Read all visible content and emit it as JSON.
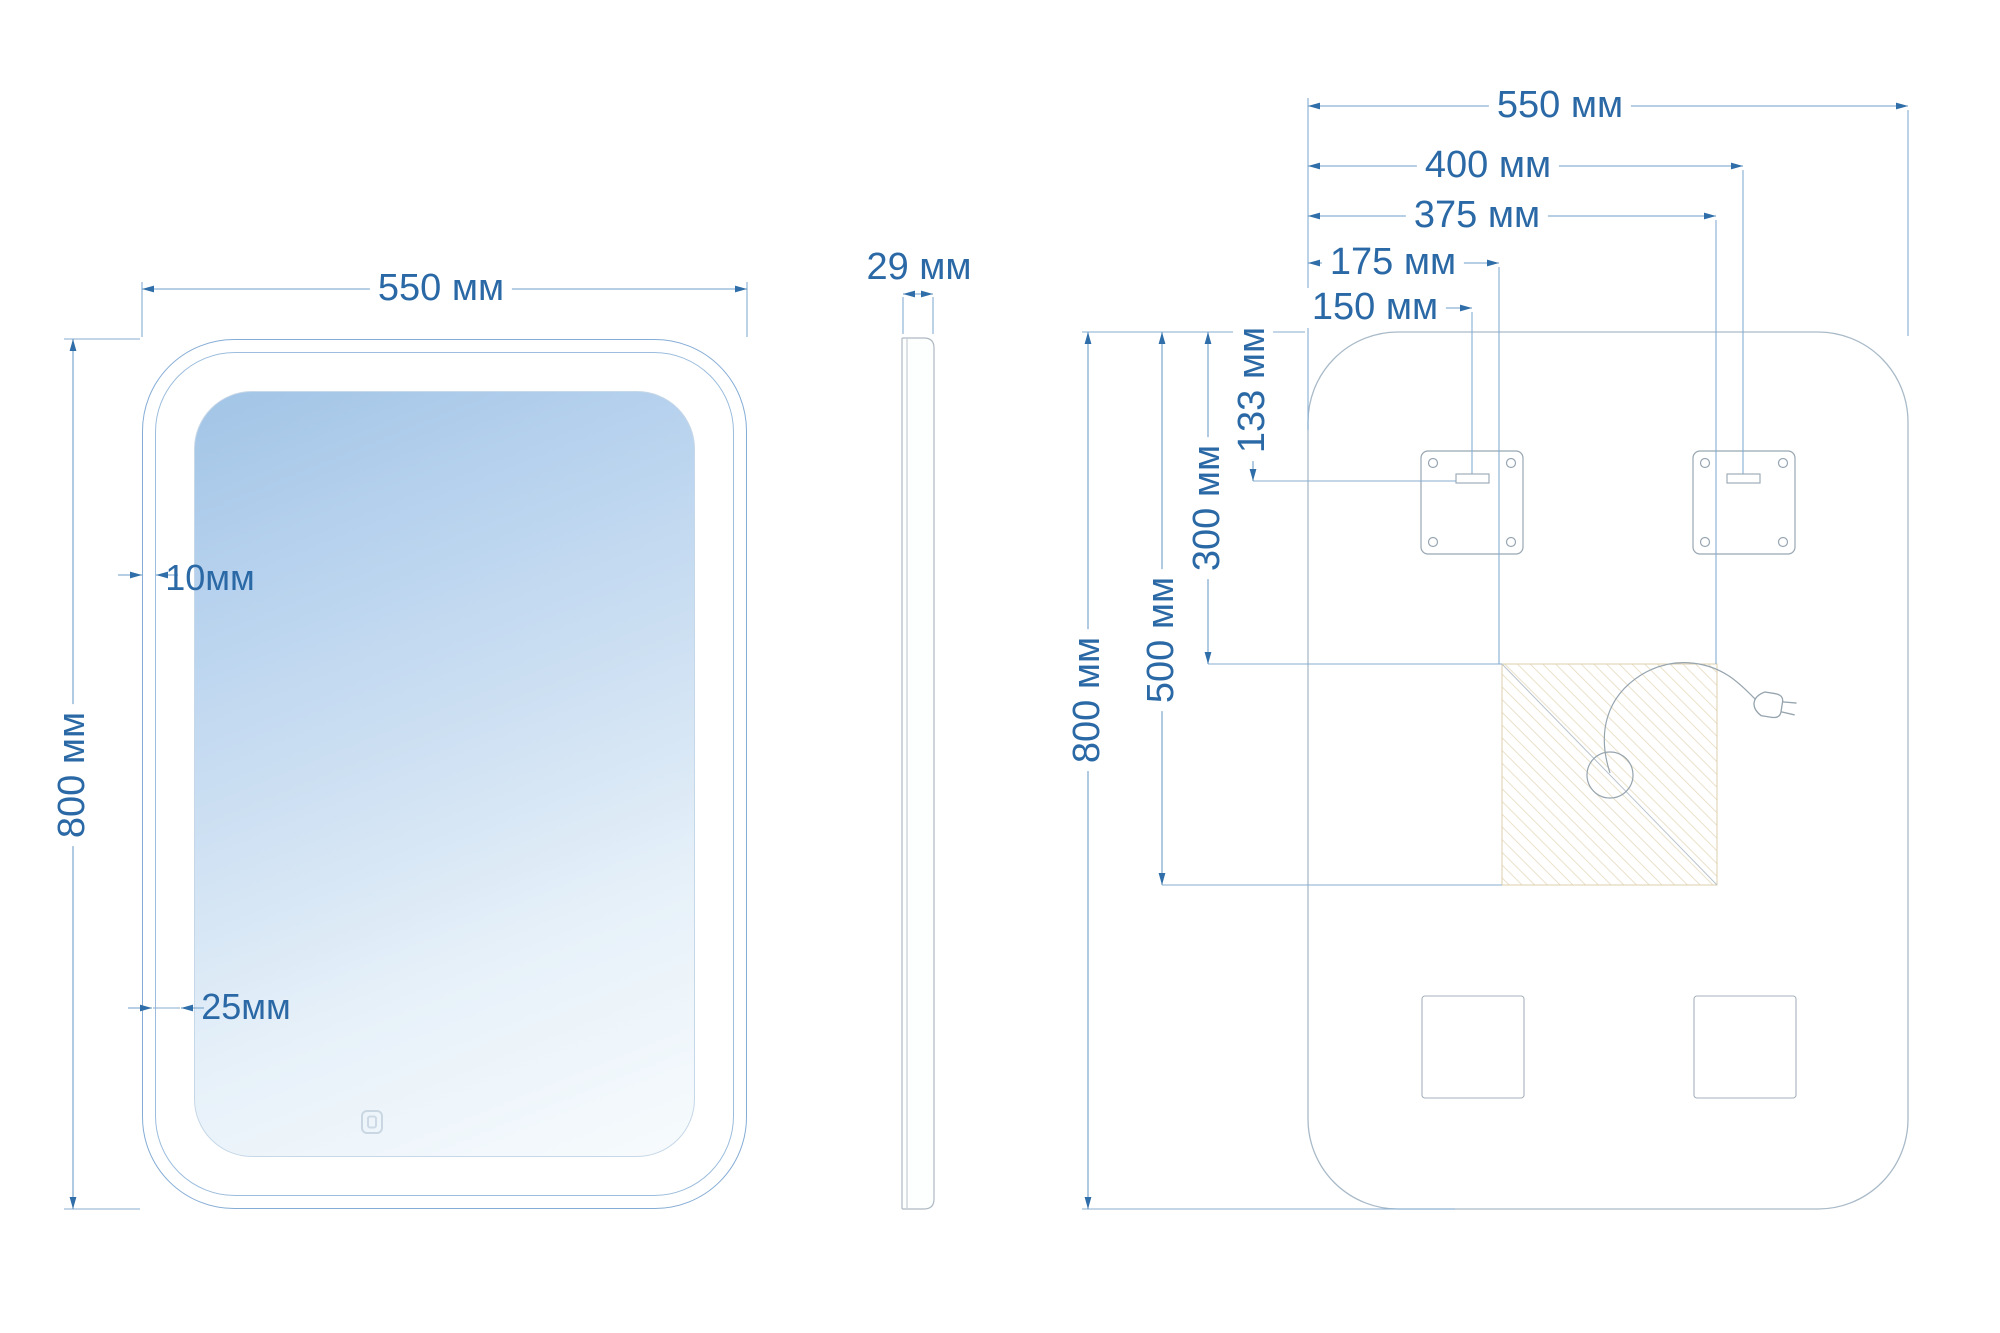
{
  "drawing": {
    "type": "technical-dimension-drawing",
    "units": "мм",
    "front_view": {
      "width_label": "550 мм",
      "height_label": "800 мм",
      "led_band_width_label": "10мм",
      "frame_gap_label": "25мм",
      "touch_icon": "touch-sensor-icon"
    },
    "side_view": {
      "thickness_label": "29 мм"
    },
    "back_view": {
      "width_label": "550 мм",
      "height_label": "800 мм",
      "right_mount_label": "400 мм",
      "zone_right_label": "375 мм",
      "zone_left_label": "175 мм",
      "left_mount_label": "150 мм",
      "mount_drop_label": "133 мм",
      "zone_top_label": "300 мм",
      "zone_bottom_label": "500 мм",
      "icons": [
        "mounting-plate-icon",
        "keyhole-slot-icon",
        "cable-gland-icon",
        "power-plug-icon",
        "driver-zone-hatch"
      ]
    },
    "colors": {
      "dimension_text": "#2a69a5",
      "dimension_line": "#7aa6cf",
      "outline_light": "#a9bac8",
      "detail_gray": "#98a6b2",
      "hatch_tan": "#e6dabd",
      "led_band_blue": "#a6c6e7",
      "mirror_gradient_top": "#a2c4e6",
      "mirror_gradient_bottom": "#f7fbfd",
      "background": "#ffffff"
    }
  }
}
